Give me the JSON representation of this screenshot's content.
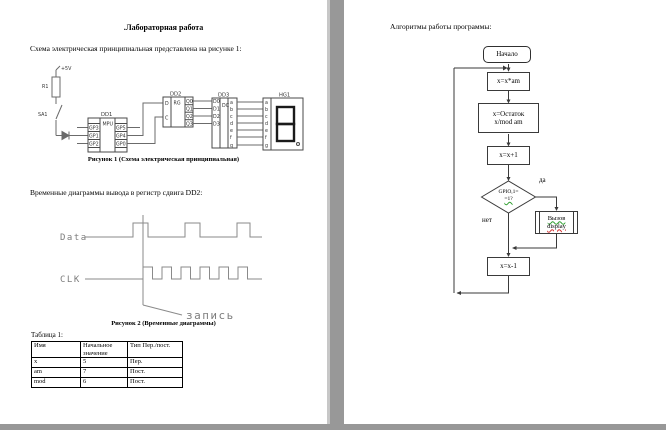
{
  "left_page": {
    "title": ".Лабораторная работа",
    "intro": "Схема электрическая принципиальная представлена на рисунке 1:",
    "figure1": {
      "caption": "Рисунок 1 (Схема электрическая принципиальная)",
      "power_label": "+5V",
      "r1_label": "R1",
      "sa1_label": "SA1",
      "dd1": {
        "name": "DD1",
        "type": "MPU",
        "left_pins": [
          "GP3",
          "GP1",
          "GP2"
        ],
        "right_pins": [
          "GP5",
          "GP4",
          "GP0"
        ]
      },
      "dd2": {
        "name": "DD2",
        "type": "RG",
        "left_pins": [
          "D",
          "C"
        ],
        "right_pins": [
          "Q0",
          "Q1",
          "Q2",
          "Q3"
        ]
      },
      "dd3": {
        "name": "DD3",
        "type": "DC",
        "left_pins": [
          "D0",
          "D1",
          "D2",
          "D3"
        ],
        "right_pins": [
          "a",
          "b",
          "c",
          "d",
          "e",
          "f",
          "g"
        ]
      },
      "hg1": {
        "name": "HG1",
        "pins": [
          "a",
          "b",
          "c",
          "d",
          "e",
          "f",
          "g"
        ]
      }
    },
    "timing_intro": "Временные диаграммы вывода в регистр сдвига DD2:",
    "figure2": {
      "caption": "Рисунок 2 (Временные диаграммы)",
      "data_label": "Data",
      "clk_label": "CLK",
      "annotation": "запись"
    },
    "table": {
      "label": "Таблица 1:",
      "headers": [
        "Имя",
        "Начальное значение",
        "Тип Пер./пост."
      ],
      "rows": [
        [
          "x",
          "5",
          "Пер."
        ],
        [
          "am",
          "7",
          "Пост."
        ],
        [
          "mod",
          "6",
          "Пост."
        ]
      ]
    }
  },
  "right_page": {
    "title": "Алгоритмы работы программы:",
    "flowchart": {
      "start": "Начало",
      "step_multiply": "x=x*am",
      "step_mod_line1": "x=Остаток",
      "step_mod_line2": "x/mod am",
      "step_inc": "x=x+1",
      "decision_line1": "GPIO,1=",
      "decision_line2": "=1?",
      "branch_yes": "да",
      "branch_no": "нет",
      "call_line1": "Вызов",
      "call_line2": "display",
      "step_dec": "x=x-1"
    }
  }
}
